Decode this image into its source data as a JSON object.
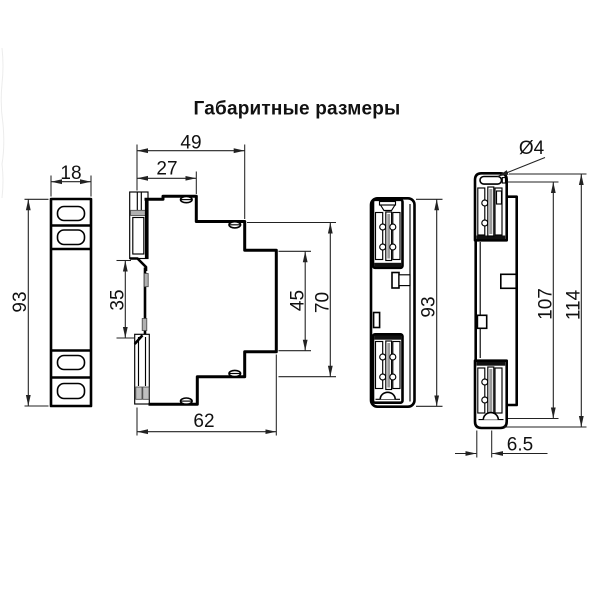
{
  "title": "Габаритные размеры",
  "views": {
    "front_narrow": {
      "dims": {
        "width": "18",
        "height": "93"
      }
    },
    "side_profile": {
      "dims": {
        "total_depth": "49",
        "upper_depth": "27",
        "din_rail_gap": "35",
        "recess_height": "45",
        "body_height": "70",
        "lower_depth": "62"
      }
    },
    "front": {
      "dims": {
        "height": "93"
      }
    },
    "rear": {
      "dims": {
        "hole_diameter": "Ø4",
        "terminal_span": "107",
        "overall_height": "114",
        "clip_offset": "6.5"
      }
    }
  },
  "colors": {
    "line": "#000000",
    "dim_line": "#222222",
    "shade": "#b0b0b0",
    "core": "#999999"
  }
}
